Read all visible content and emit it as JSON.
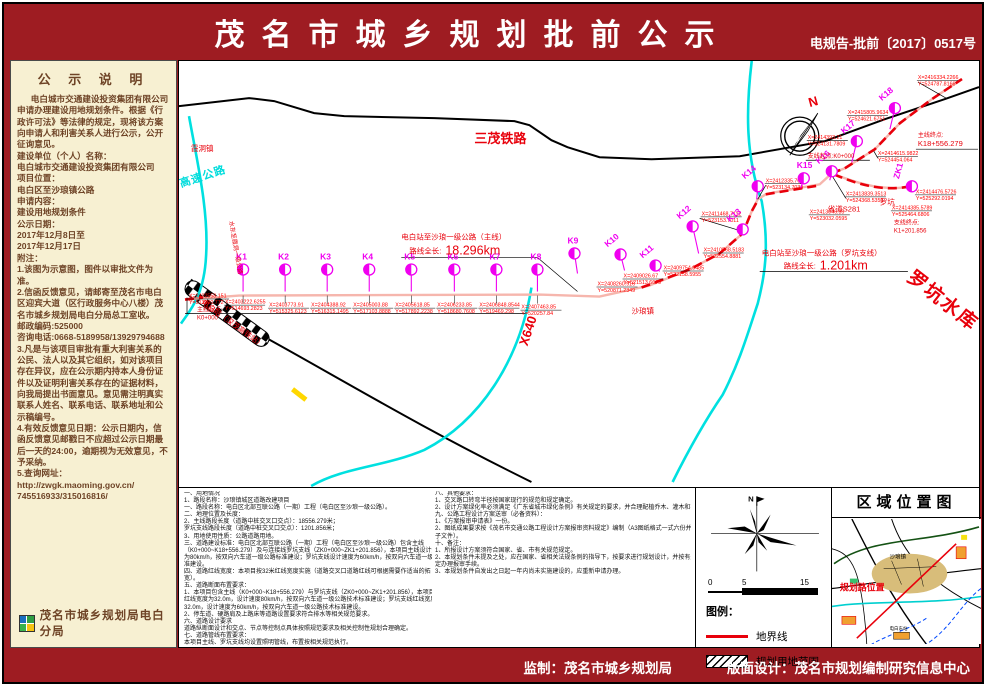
{
  "header": {
    "title": "茂名市城乡规划批前公示",
    "doc_no": "电规告-批前〔2017〕0517号"
  },
  "sidebar": {
    "title": "公 示 说 明",
    "paragraphs": [
      "电白城市交通建设投资集团有限公司申请办理建设用地规划条件。根据《行政许可法》等法律的规定，现将该方案向申请人和利害关系人进行公示，公开征询意见。",
      "建设单位（个人）名称：",
      "电白城市交通建设投资集团有限公司",
      "项目位置：",
      "电白区至沙琅镇公路",
      "申请内容：",
      "建设用地规划条件",
      "公示日期：",
      "2017年12月8日至",
      "2017年12月17日",
      "附注：",
      "1.该图为示意图，图件以审批文件为准。",
      "2.信函反馈意见，请邮寄至茂名市电白区迎宾大道（区行政服务中心八楼）茂名市城乡规划局电白分局总工室收。",
      "邮政编码:525000",
      "咨询电话:0668-5189958/13929794688",
      "3.凡是与该项目审批有重大利害关系的公民、法人以及其它组织，如对该项目存在异议，应在公示期内持本人身份证件以及证明利害关系存在的证据材料，向我局提出书面意见。意见需注明真实联系人姓名、联系电话、联系地址和公示稿编号。",
      "4.有效反馈意见日期：公示日期内，信函反馈意见邮戳日不应超过公示日期最后一天的24:00，逾期视为无效意见，不予采纳。",
      "5.查询网址：",
      "http://zwgk.maoming.gov.cn/",
      "745516933/315016816/"
    ],
    "footer_org": "茂名市城乡规划局电白分局"
  },
  "map": {
    "labels": [
      {
        "t": "三茂铁路",
        "x": 295,
        "y": 82,
        "cls": "rl"
      },
      {
        "t": "霞洞镇",
        "x": 12,
        "y": 90,
        "cls": "r"
      },
      {
        "t": "高速公路",
        "x": 2,
        "y": 126,
        "cls": "cy",
        "rot": -18
      },
      {
        "t": "水东至霞洞一级公路",
        "x": 50,
        "y": 160,
        "cls": "rs",
        "rot": 80
      },
      {
        "t": "电白站（深茂高铁站）",
        "x": 22,
        "y": 242,
        "cls": "r",
        "rot": 36
      },
      {
        "t": "电白站至沙琅一级公路（主线）",
        "x": 222,
        "y": 178,
        "cls": "r"
      },
      {
        "t": "路线全长:",
        "x": 230,
        "y": 192,
        "cls": "r"
      },
      {
        "t": "18.296km",
        "x": 266,
        "y": 193,
        "cls": "rb"
      },
      {
        "t": "电白站至沙琅一级公路（罗坑支线）",
        "x": 582,
        "y": 194,
        "cls": "r"
      },
      {
        "t": "路线全长:",
        "x": 604,
        "y": 207,
        "cls": "r"
      },
      {
        "t": "1.201km",
        "x": 640,
        "y": 208,
        "cls": "rb"
      },
      {
        "t": "主线起点:",
        "x": 18,
        "y": 250,
        "cls": "rs"
      },
      {
        "t": "K0+000",
        "x": 18,
        "y": 258,
        "cls": "rs"
      },
      {
        "t": "主线终点:",
        "x": 738,
        "y": 76,
        "cls": "rs"
      },
      {
        "t": "K18+556.279",
        "x": 738,
        "y": 85,
        "cls": "r"
      },
      {
        "t": "支线起点:K0+000",
        "x": 628,
        "y": 97,
        "cls": "rs"
      },
      {
        "t": "支线终点:",
        "x": 714,
        "y": 163,
        "cls": "rs"
      },
      {
        "t": "K1+201.856",
        "x": 714,
        "y": 171,
        "cls": "rs"
      },
      {
        "t": "省道S281",
        "x": 648,
        "y": 150,
        "cls": "r"
      },
      {
        "t": "罗坑",
        "x": 700,
        "y": 143,
        "cls": "r"
      },
      {
        "t": "沙琅镇",
        "x": 452,
        "y": 252,
        "cls": "r"
      },
      {
        "t": "罗坑水库",
        "x": 726,
        "y": 218,
        "cls": "rh",
        "rot": 38
      },
      {
        "t": "X640",
        "x": 348,
        "y": 285,
        "cls": "rl",
        "rot": -72
      },
      {
        "t": "N",
        "x": 630,
        "y": 46,
        "cls": "rl",
        "rot": -15
      }
    ],
    "kpoints": [
      {
        "n": "K1",
        "x": 64,
        "y": 208,
        "sx": 64,
        "sy": 230,
        "rot": 0,
        "drop": true
      },
      {
        "n": "K2",
        "x": 106,
        "y": 208,
        "sx": 106,
        "sy": 230,
        "rot": 0,
        "drop": true
      },
      {
        "n": "K3",
        "x": 148,
        "y": 208,
        "sx": 148,
        "sy": 230,
        "rot": 0,
        "drop": true
      },
      {
        "n": "K4",
        "x": 190,
        "y": 208,
        "sx": 190,
        "sy": 230,
        "rot": 0,
        "drop": true
      },
      {
        "n": "K5",
        "x": 232,
        "y": 208,
        "sx": 232,
        "sy": 230,
        "rot": 0,
        "drop": true
      },
      {
        "n": "K6",
        "x": 275,
        "y": 208,
        "sx": 275,
        "sy": 230,
        "rot": 0,
        "drop": true
      },
      {
        "n": "K7",
        "x": 317,
        "y": 208,
        "sx": 317,
        "sy": 230,
        "rot": 0,
        "drop": true
      },
      {
        "n": "K8",
        "x": 358,
        "y": 208,
        "sx": 358,
        "sy": 230,
        "rot": 0,
        "drop": true
      },
      {
        "n": "K9",
        "x": 395,
        "y": 192,
        "sx": 398,
        "sy": 212,
        "rot": 0
      },
      {
        "n": "K10",
        "x": 441,
        "y": 193,
        "sx": 445,
        "sy": 209,
        "rot": -40
      },
      {
        "n": "K11",
        "x": 476,
        "y": 204,
        "sx": 480,
        "sy": 210,
        "rot": -40
      },
      {
        "n": "K12",
        "x": 513,
        "y": 165,
        "sx": 519,
        "sy": 192,
        "rot": -40
      },
      {
        "n": "K13",
        "x": 563,
        "y": 168,
        "sx": 561,
        "sy": 172,
        "rot": -40
      },
      {
        "n": "K14",
        "x": 578,
        "y": 125,
        "sx": 577,
        "sy": 138,
        "rot": -40
      },
      {
        "n": "K15",
        "x": 624,
        "y": 117,
        "sx": 621,
        "sy": 127,
        "rot": 0
      },
      {
        "n": "K16",
        "x": 652,
        "y": 110,
        "sx": 650,
        "sy": 119,
        "rot": -40
      },
      {
        "n": "K17",
        "x": 677,
        "y": 80,
        "sx": 672,
        "sy": 101,
        "rot": -40
      },
      {
        "n": "K18",
        "x": 715,
        "y": 47,
        "sx": 710,
        "sy": 68,
        "rot": -40
      },
      {
        "n": "ZK1",
        "x": 732,
        "y": 125,
        "sx": 727,
        "sy": 127,
        "rot": -75
      }
    ],
    "coords": [
      {
        "x": 10,
        "y": 236,
        "l1": "X=2402558.151",
        "l2": "Y=513990.772"
      },
      {
        "x": 46,
        "y": 242,
        "l1": "X=2403222.6255",
        "l2": "Y=514693.2823"
      },
      {
        "x": 90,
        "y": 245,
        "l1": "X=2403773.91",
        "l2": "Y=515325.6123"
      },
      {
        "x": 132,
        "y": 245,
        "l1": "X=2404388.92",
        "l2": "Y=516315.1495"
      },
      {
        "x": 174,
        "y": 245,
        "l1": "X=2405003.88",
        "l2": "Y=517103.8888"
      },
      {
        "x": 216,
        "y": 245,
        "l1": "X=2405618.85",
        "l2": "Y=517892.2238"
      },
      {
        "x": 258,
        "y": 245,
        "l1": "X=2406233.85",
        "l2": "Y=518680.7608"
      },
      {
        "x": 300,
        "y": 245,
        "l1": "X=2406848.8544",
        "l2": "Y=519469.298"
      },
      {
        "x": 342,
        "y": 247,
        "l1": "X=2407463.85",
        "l2": "Y=520257.84"
      },
      {
        "x": 418,
        "y": 224,
        "l1": "X=2408260.916",
        "l2": "Y=520871.2349"
      },
      {
        "x": 444,
        "y": 216,
        "l1": "X=2409026.67",
        "l2": "Y=521513.6679"
      },
      {
        "x": 484,
        "y": 208,
        "l1": "X=2409754.9485",
        "l2": "Y=522158.5955"
      },
      {
        "x": 524,
        "y": 190,
        "l1": "X=2410568.5183",
        "l2": "Y=522554.8881"
      },
      {
        "x": 522,
        "y": 154,
        "l1": "X=2411468.7112",
        "l2": "Y=523153.7011"
      },
      {
        "x": 586,
        "y": 121,
        "l1": "X=2412335.7043",
        "l2": "Y=523134.7039"
      },
      {
        "x": 630,
        "y": 152,
        "l1": "X=2413046.35",
        "l2": "Y=523032.0595"
      },
      {
        "x": 666,
        "y": 134,
        "l1": "X=2413839.3513",
        "l2": "Y=524368.5353"
      },
      {
        "x": 698,
        "y": 94,
        "l1": "X=2414615.9822",
        "l2": "Y=524454.064"
      },
      {
        "x": 628,
        "y": 78,
        "l1": "X=2414393.21",
        "l2": "Y=524131.7809"
      },
      {
        "x": 668,
        "y": 53,
        "l1": "X=2415805.9634",
        "l2": "Y=524621.6751"
      },
      {
        "x": 738,
        "y": 18,
        "l1": "X=2416334.2266",
        "l2": "Y=524787.8166"
      },
      {
        "x": 736,
        "y": 132,
        "l1": "X=2414476.5726",
        "l2": "Y=525292.0194"
      },
      {
        "x": 712,
        "y": 148,
        "l1": "X=2414385.5789",
        "l2": "Y=525464.6806"
      }
    ]
  },
  "notes": {
    "left": [
      "一、用地情况",
      "1、路段名称：沙琅镇城区道路改建项目",
      "一、路段名称：电白区北部互联公路（一期）工程（电白区至沙琅一级公路）。",
      "二、地理位置及长度：",
      "2、主线路段长度（道路中桩交叉口交点）：18556.279米；",
      "罗坑支线路段长度（道路中桩交叉口交点）：1201.856米；",
      "3、用地使用性质：公路道路用地。",
      "三、道路建设标准：电白区北部互联公路（一期）工程（电白区至沙琅一级公路）包含主线",
      "（K0+000~K18+556.279）及与连接线罗坑支线（ZK0+000~ZK1+201.856），本项目主线设计速度",
      "为80km/h，按双向六车道一级公路标准建设；罗坑支线设计速度为60km/h，按双向六车道一级公路标",
      "准建设。",
      "四、道路红线宽度：本项目按32米红线宽度实施（道路交叉口道路红线可根据需要作适当的拓",
      "宽）。",
      "五、道路断面布置要求：",
      "1、本项目包含主线（K0+000~K18+556.279）与罗坑支线（ZK0+000~ZK1+201.856），本项目主线",
      "红线宽度为32.0m，设计速度80km/h，按双向六车道一级公路技术标准建设；罗坑支线红线宽度为",
      "32.0m，设计速度为60km/h，按双向六车道一级公路技术标准建设。",
      "2、停车道、硬路肩及上路床等道路设置要求符合排水等相关规范要求。",
      "六、道路设计要求",
      "道路纵断面设计和交点、节点等控制点具体按照规范要求及相关控制性规划合理确定。",
      "七、道路管线布置要求：",
      "本项目主线、罗坑支线均设置照明管线，布置按相关规范执行。"
    ],
    "right": [
      "八、其他要求：",
      "1、交叉路口转弯半径按国家现行的规范和规定确定。",
      "2、设计方案绿化率必须满足《广东省城市绿化条例》有关规定的要求，并合理配植乔木、灌木和花卉。",
      "九、公路工程设计方案送审（必备资料）：",
      "1、《方案报审申请表》一份。",
      "2、图纸成果要求按《茂名市交通公路工程设计方案报审资料规定》编制（A3图纸格式一式六份并附电",
      "子文件）。",
      "十、备注：",
      "1、所报设计方案须符合国家、省、市有关规范规定。",
      "2、本规划条件未提及之处，应在国家、省相关法规条例的指导下，按要求进行规划设计，并按有关规",
      "定办理报审手续。",
      "3、本规划条件自发出之日起一年内尚未实施建设的，应重新申请办理。"
    ]
  },
  "legend": {
    "north": "N",
    "scale": [
      "0",
      "5",
      "15"
    ],
    "title": "图例：",
    "items": [
      {
        "label": "地界线"
      },
      {
        "label": "规划用地范围"
      }
    ]
  },
  "region_map": {
    "title": "区域位置图",
    "road_label": "规划路位置",
    "town_label": "沙琅镇",
    "station_label": "电白东站"
  },
  "footer": {
    "supervisor": "监制：茂名市城乡规划局",
    "design": "版面设计：茂名市规划编制研究信息中心"
  }
}
